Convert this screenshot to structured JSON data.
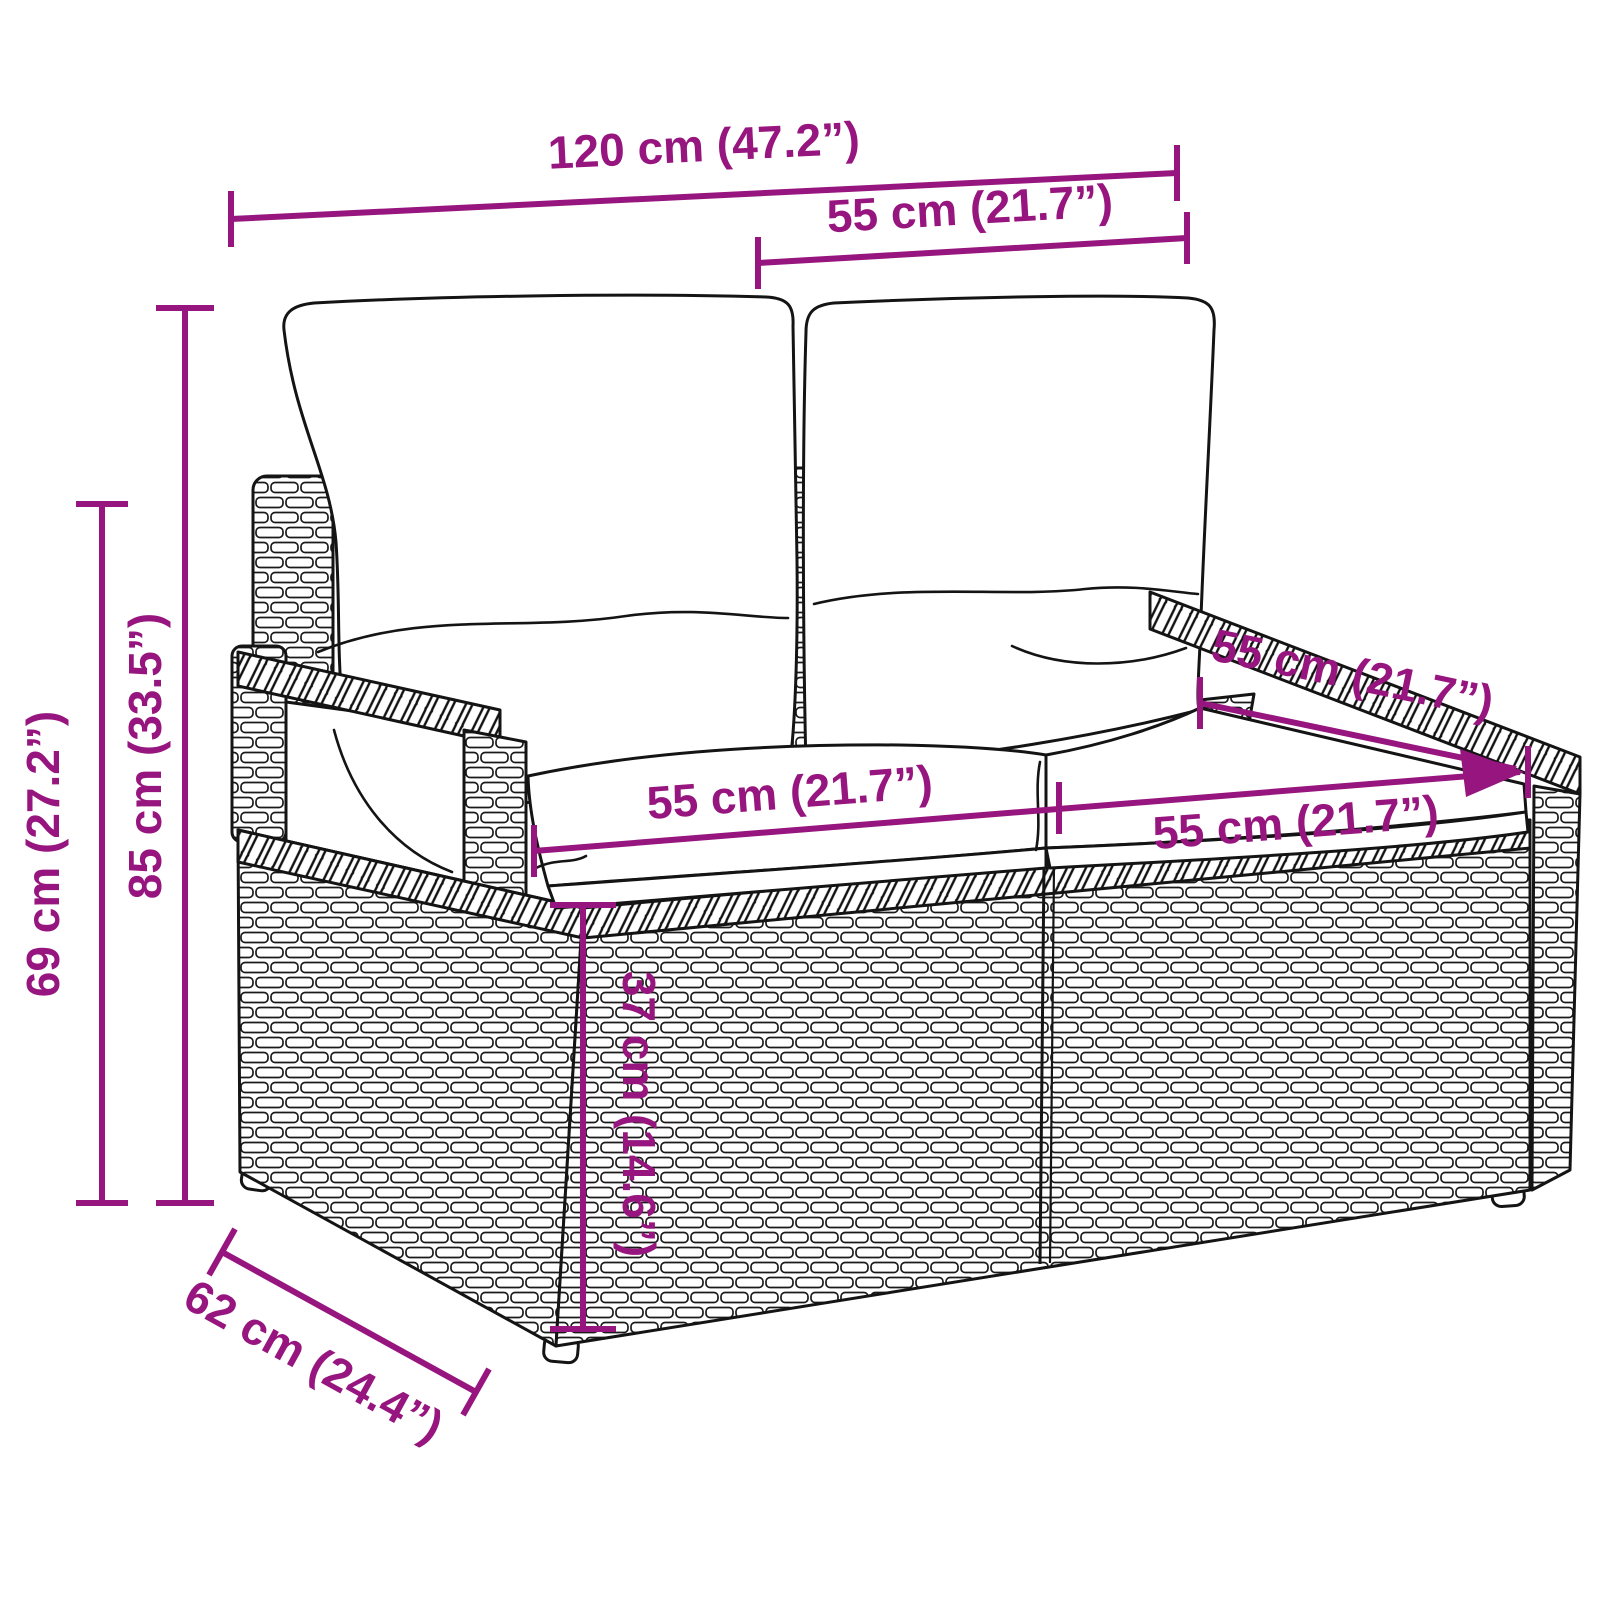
{
  "diagram": {
    "product": "poly rattan 2-seater garden bench with cushions",
    "accent_color": "#97157E",
    "line_color": "#141414",
    "dimensions": {
      "overall_width": {
        "label": "120 cm (47.2”)",
        "value_cm": 120,
        "value_in": 47.2
      },
      "back_width": {
        "label": "55 cm (21.7”)",
        "value_cm": 55,
        "value_in": 21.7
      },
      "seat_depth": {
        "label": "55 cm (21.7”)",
        "value_cm": 55,
        "value_in": 21.7
      },
      "seat_width_left": {
        "label": "55 cm (21.7”)",
        "value_cm": 55,
        "value_in": 21.7
      },
      "seat_width_right": {
        "label": "55 cm (21.7”)",
        "value_cm": 55,
        "value_in": 21.7
      },
      "total_height": {
        "label": "85 cm (33.5”)",
        "value_cm": 85,
        "value_in": 33.5
      },
      "armrest_height": {
        "label": "69 cm (27.2”)",
        "value_cm": 69,
        "value_in": 27.2
      },
      "seat_height": {
        "label": "37 cm (14.6”)",
        "value_cm": 37,
        "value_in": 14.6
      },
      "depth": {
        "label": "62 cm (24.4”)",
        "value_cm": 62,
        "value_in": 24.4
      }
    }
  }
}
